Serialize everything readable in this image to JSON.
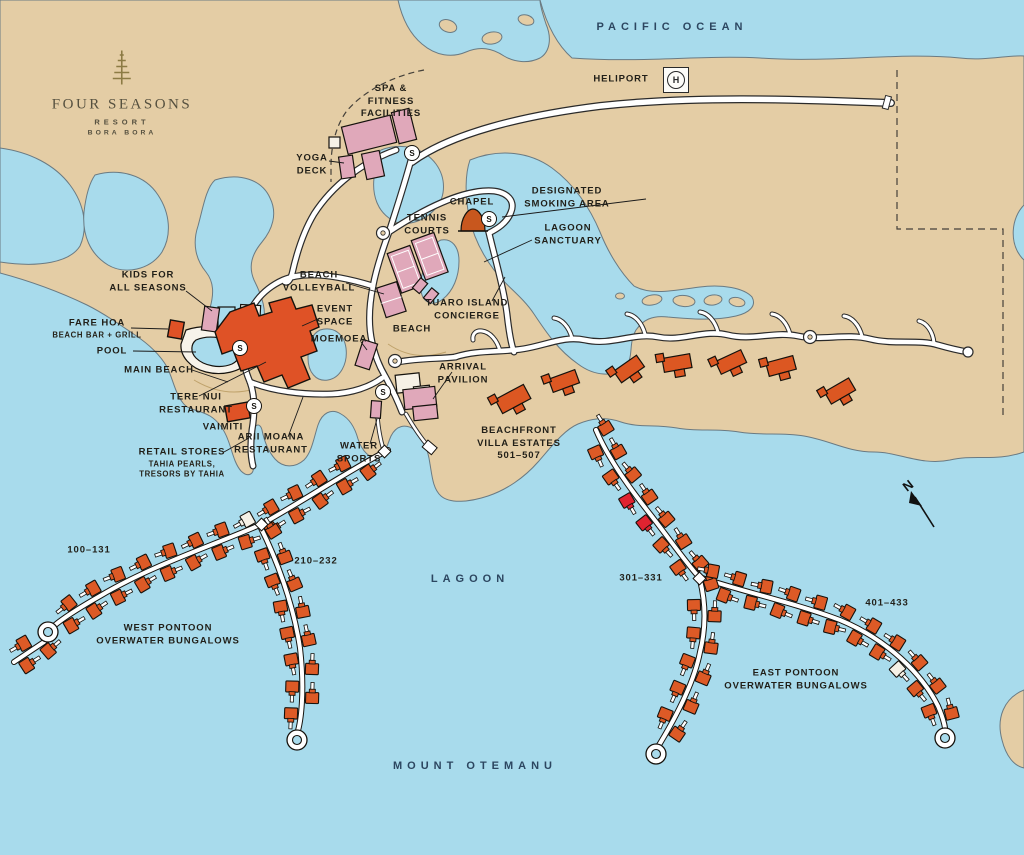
{
  "logo": {
    "name": "FOUR SEASONS",
    "line2": "RESORT",
    "line3": "BORA BORA",
    "icon": "pine-tree-icon"
  },
  "water": {
    "ocean": "PACIFIC OCEAN",
    "lagoon": "LAGOON",
    "mountain": "MOUNT OTEMANU"
  },
  "markers": {
    "shuttle": "S",
    "heliport": "HELIPORT",
    "heliport_h": "H",
    "north": "N"
  },
  "places": {
    "spa": [
      "SPA &",
      "FITNESS",
      "FACILITIES"
    ],
    "yoga": [
      "YOGA",
      "DECK"
    ],
    "chapel": "CHAPEL",
    "smoking": [
      "DESIGNATED",
      "SMOKING AREA"
    ],
    "sanctuary": [
      "LAGOON",
      "SANCTUARY"
    ],
    "tennis": [
      "TENNIS",
      "COURTS"
    ],
    "kids": [
      "KIDS FOR",
      "ALL SEASONS"
    ],
    "volleyball": [
      "BEACH",
      "VOLLEYBALL"
    ],
    "event": [
      "EVENT",
      "SPACE"
    ],
    "fare_hoa": {
      "name": "FARE HOA",
      "sub": "BEACH BAR + GRILL"
    },
    "pool": "POOL",
    "main_beach": "MAIN BEACH",
    "moemoea": "MOEMOEA",
    "beach": "BEACH",
    "tuaro": [
      "TUARO ISLAND",
      "CONCIERGE"
    ],
    "arrival": [
      "ARRIVAL",
      "PAVILION"
    ],
    "tere_nui": [
      "TERE NUI",
      "RESTAURANT"
    ],
    "vaimiti": "VAIMITI",
    "arii_moana": [
      "ARII MOANA",
      "RESTAURANT"
    ],
    "retail": {
      "name": "RETAIL STORES",
      "sub": [
        "TAHIA PEARLS,",
        "TRESORS BY TAHIA"
      ]
    },
    "water_sports": [
      "WATER",
      "SPORTS"
    ],
    "villa_estates": [
      "BEACHFRONT",
      "VILLA ESTATES",
      "501–507"
    ],
    "west_pontoon": [
      "WEST PONTOON",
      "OVERWATER BUNGALOWS"
    ],
    "east_pontoon": [
      "EAST PONTOON",
      "OVERWATER BUNGALOWS"
    ],
    "ranges": {
      "west_arc": "100–131",
      "west_branch": "210–232",
      "east_branch": "301–331",
      "east_arc": "401–433"
    }
  },
  "colors": {
    "water": "#a8dbec",
    "land": "#e4cda5",
    "road": "#ffffff",
    "building_pink": "#e0a8ba",
    "building_orange": "#df5226",
    "bungalow": "#dd5a26",
    "bungalow_highlight": "#e02330"
  }
}
